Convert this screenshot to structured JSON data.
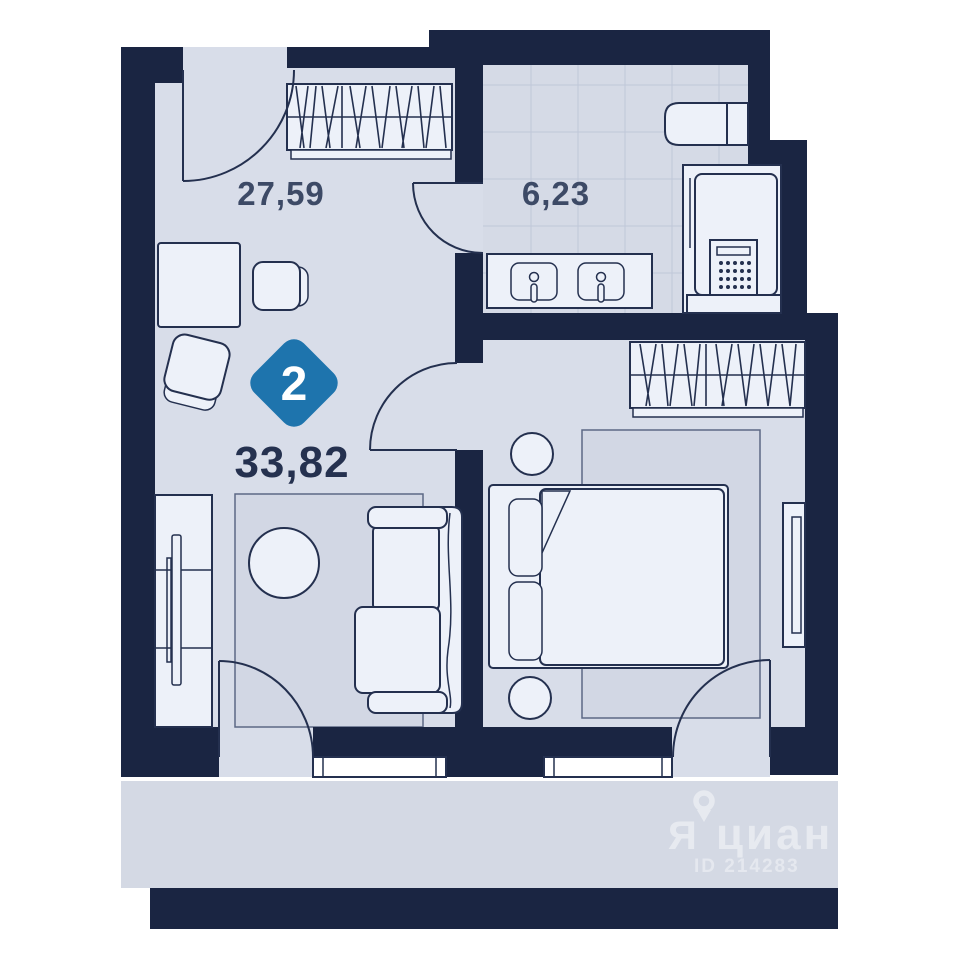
{
  "plan": {
    "badge": {
      "rooms_count": "2"
    },
    "areas": {
      "total": "33,82",
      "living_room": "27,59",
      "bathroom": "6,23"
    }
  },
  "watermark": {
    "logo_letter": "Я",
    "brand": "циан",
    "id_label": "ID 214283",
    "pin_icon": "map-pin-icon"
  },
  "colors": {
    "wall": "#1a2542",
    "floor": "#d8dde9",
    "bathroom_floor": "#d5dae6",
    "balcony_strip": "#d4d9e4",
    "furniture": "#edf1f9",
    "outline": "#24304f",
    "rug": "#d2d7e4",
    "tile_line": "#c0c8d8",
    "badge_blue": "#1e74ad",
    "room_label": "#3d4a66",
    "total_label": "#25314f",
    "watermark": "#ffffff"
  },
  "fixtures": [
    "wardrobe",
    "door-swing",
    "window",
    "sink",
    "toilet",
    "water-heater",
    "bed",
    "pillow",
    "sofa",
    "tv",
    "tv-stand",
    "rug",
    "coffee-table",
    "desk",
    "chair",
    "side-table"
  ]
}
